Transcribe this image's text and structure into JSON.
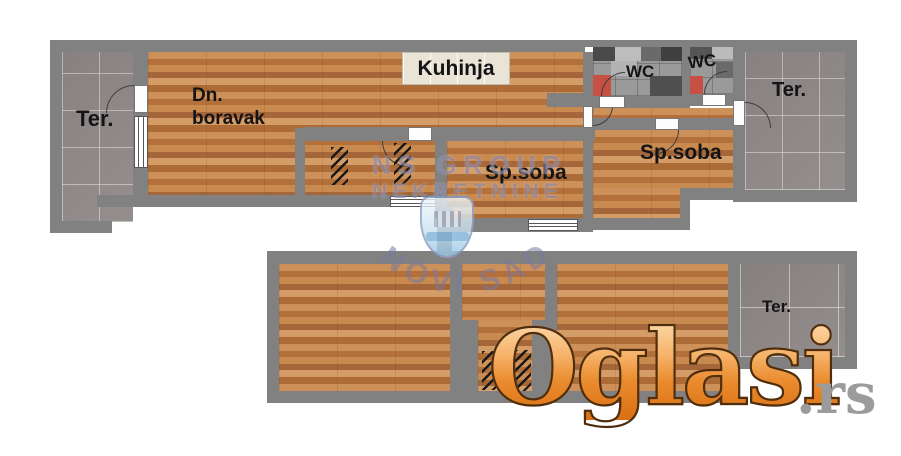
{
  "rooms": {
    "kitchen": {
      "label": "Kuhinja"
    },
    "living": {
      "line1": "Dn.",
      "line2": "boravak"
    },
    "terrace_left": {
      "label": "Ter."
    },
    "terrace_right": {
      "label": "Ter."
    },
    "terrace_bottom": {
      "label": "Ter."
    },
    "wc_left": {
      "label": "WC"
    },
    "wc_right": {
      "label": "WC"
    },
    "bedroom_middle": {
      "label": "Sp.soba"
    },
    "bedroom_right": {
      "label": "Sp.soba"
    }
  },
  "watermark": {
    "agency_top": "NS GROUP",
    "agency_bottom": "NEKRETNINE",
    "city": "NOVI SAD"
  },
  "logo": {
    "brand": "Oglasi",
    "tld": ".rs"
  },
  "colors": {
    "wall": "#818181",
    "wood": "#bd7c45",
    "terrace_tile": "#8f8888",
    "wc_accent": "#c75044",
    "watermark": "#7676a0",
    "logo_orange_light": "#fdddb2",
    "logo_orange_dark": "#d96f12",
    "logo_tld_gray": "#9b9b9b"
  }
}
